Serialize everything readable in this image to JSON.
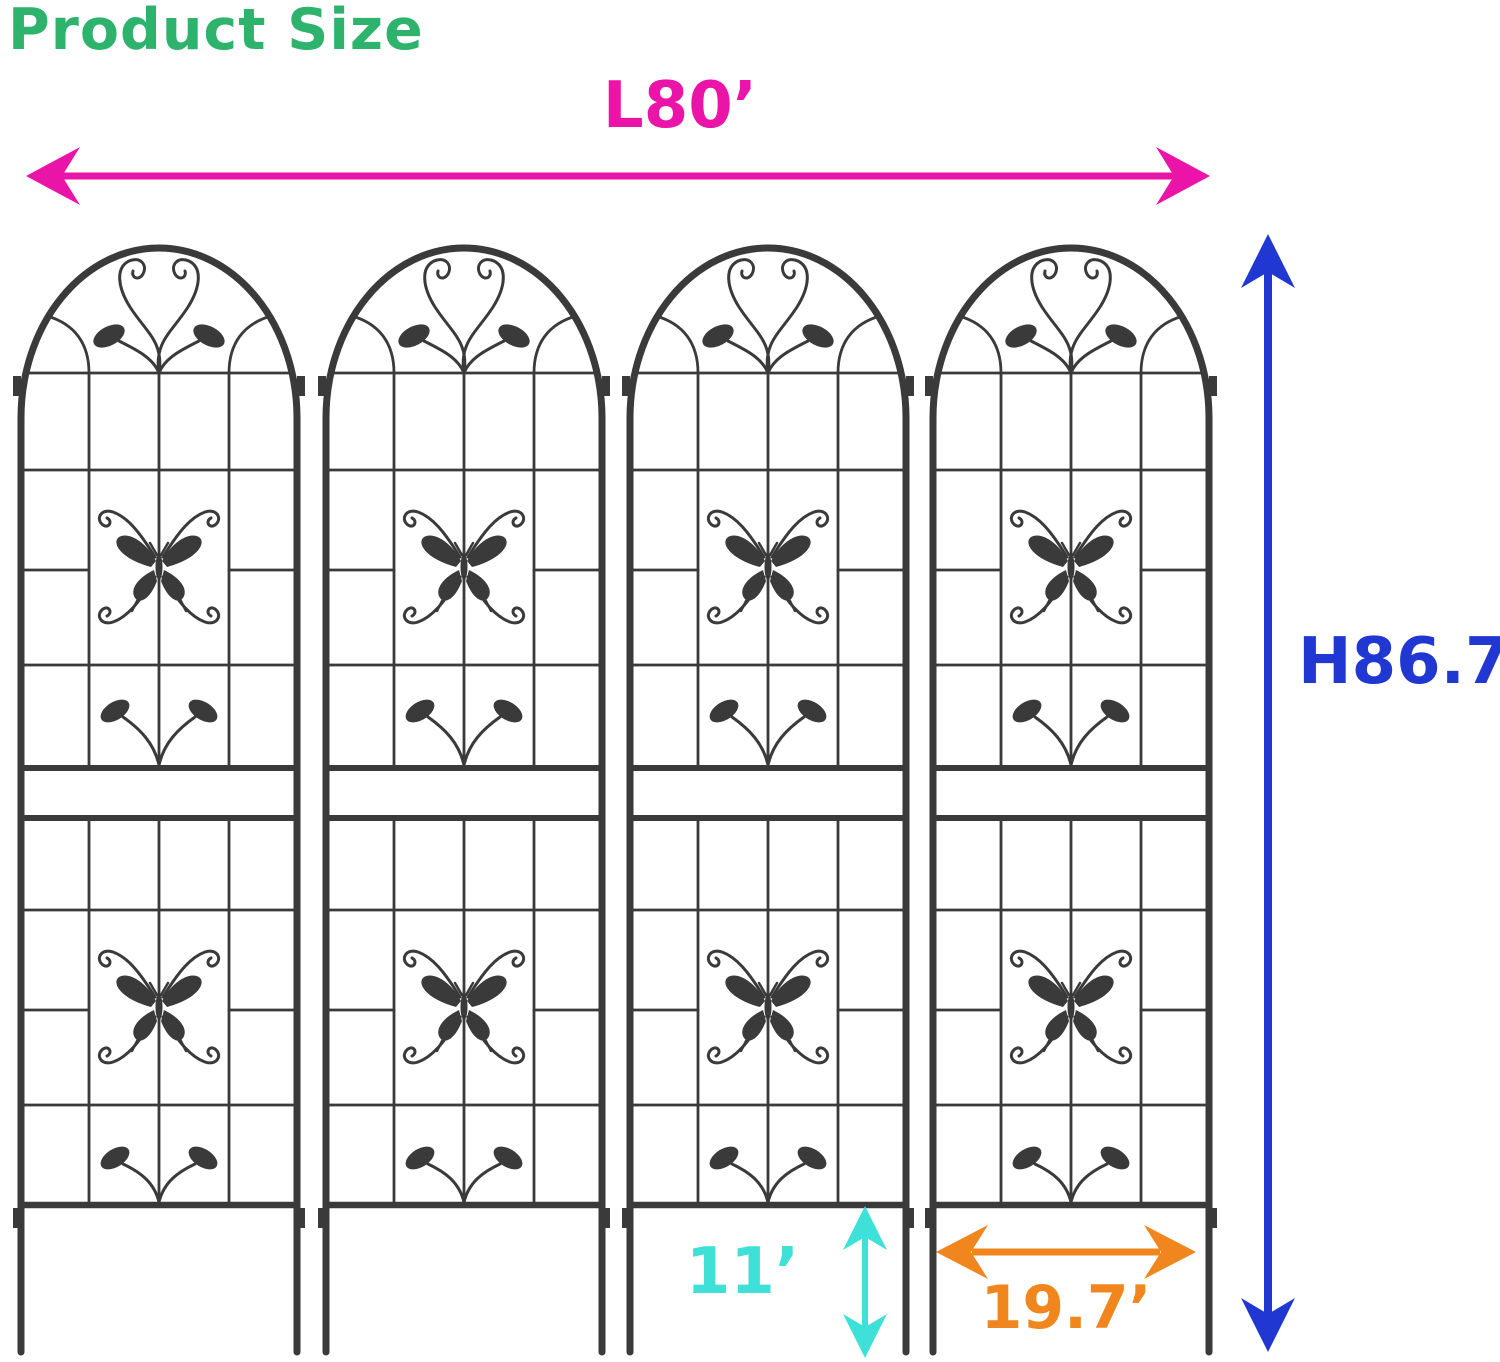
{
  "title": "Product Size",
  "colors": {
    "title": "#2db36c",
    "length": "#ea14a9",
    "height": "#2137d2",
    "spike_height": "#3fe0d8",
    "panel_width": "#f0861d",
    "trellis": "#3a3a3a",
    "background": "#ffffff"
  },
  "dimensions": {
    "length": {
      "label": "L80’"
    },
    "height": {
      "label": "H86.7’"
    },
    "spike_height": {
      "label": "11’"
    },
    "panel_width": {
      "label": "19.7’"
    }
  },
  "trellis": {
    "panel_count": 4,
    "panel_icon": "butterfly-scroll-trellis-panel"
  }
}
